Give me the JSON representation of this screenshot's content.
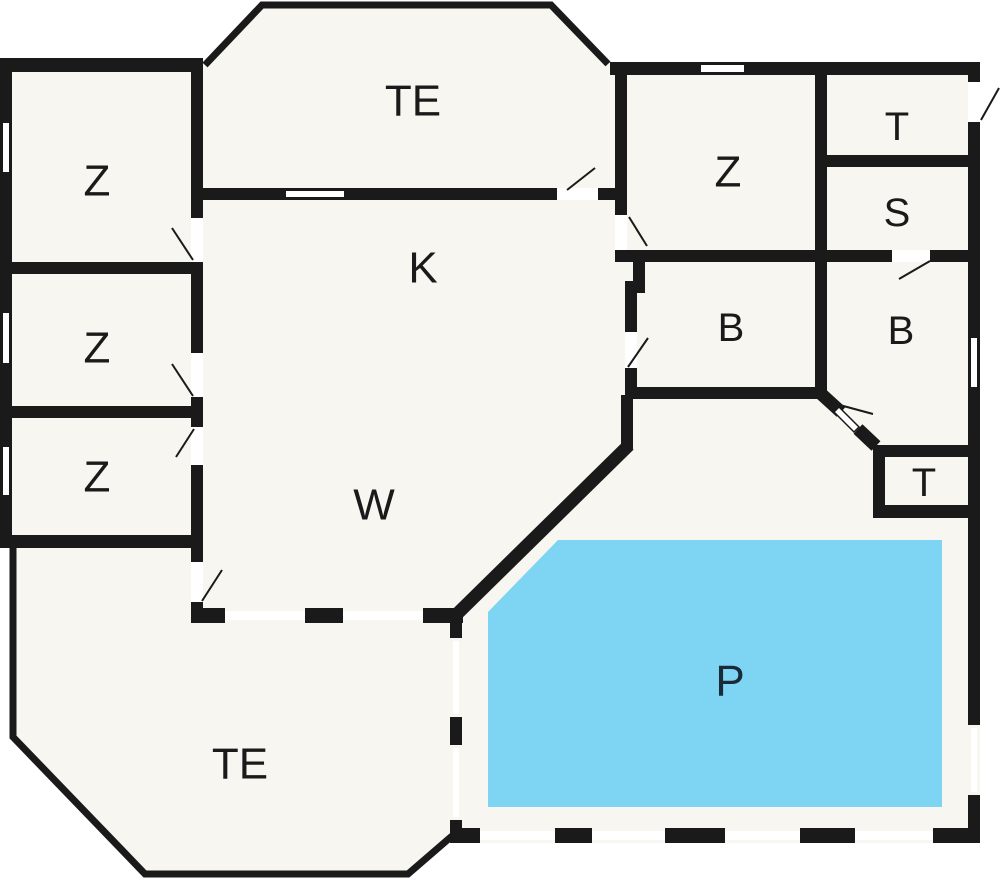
{
  "plan_title": "holiday-house-floor-plan",
  "colors": {
    "wall": "#1a1a1a",
    "floor": "#f8f6f0",
    "outside": "#ffffff",
    "pool_water": "#7ed4f3",
    "label": "#1a1a1a",
    "pool_label": "#1b2a38"
  },
  "rooms": [
    {
      "id": "te-top",
      "label": "TE",
      "x": 413,
      "y": 101,
      "size": 44
    },
    {
      "id": "z1",
      "label": "Z",
      "x": 97,
      "y": 181,
      "size": 44
    },
    {
      "id": "z2",
      "label": "Z",
      "x": 97,
      "y": 348,
      "size": 44
    },
    {
      "id": "z3",
      "label": "Z",
      "x": 97,
      "y": 477,
      "size": 44
    },
    {
      "id": "k",
      "label": "K",
      "x": 423,
      "y": 268,
      "size": 44
    },
    {
      "id": "w",
      "label": "W",
      "x": 374,
      "y": 505,
      "size": 44
    },
    {
      "id": "z-right",
      "label": "Z",
      "x": 728,
      "y": 172,
      "size": 44
    },
    {
      "id": "t-top",
      "label": "T",
      "x": 897,
      "y": 127,
      "size": 40
    },
    {
      "id": "s",
      "label": "S",
      "x": 897,
      "y": 213,
      "size": 40
    },
    {
      "id": "b-left",
      "label": "B",
      "x": 731,
      "y": 328,
      "size": 40
    },
    {
      "id": "b-right",
      "label": "B",
      "x": 901,
      "y": 331,
      "size": 40
    },
    {
      "id": "t-bottom",
      "label": "T",
      "x": 924,
      "y": 483,
      "size": 40
    },
    {
      "id": "te-bottom",
      "label": "TE",
      "x": 240,
      "y": 764,
      "size": 44
    },
    {
      "id": "pool",
      "label": "P",
      "x": 730,
      "y": 681,
      "size": 44,
      "color": "#1b2a38"
    }
  ]
}
